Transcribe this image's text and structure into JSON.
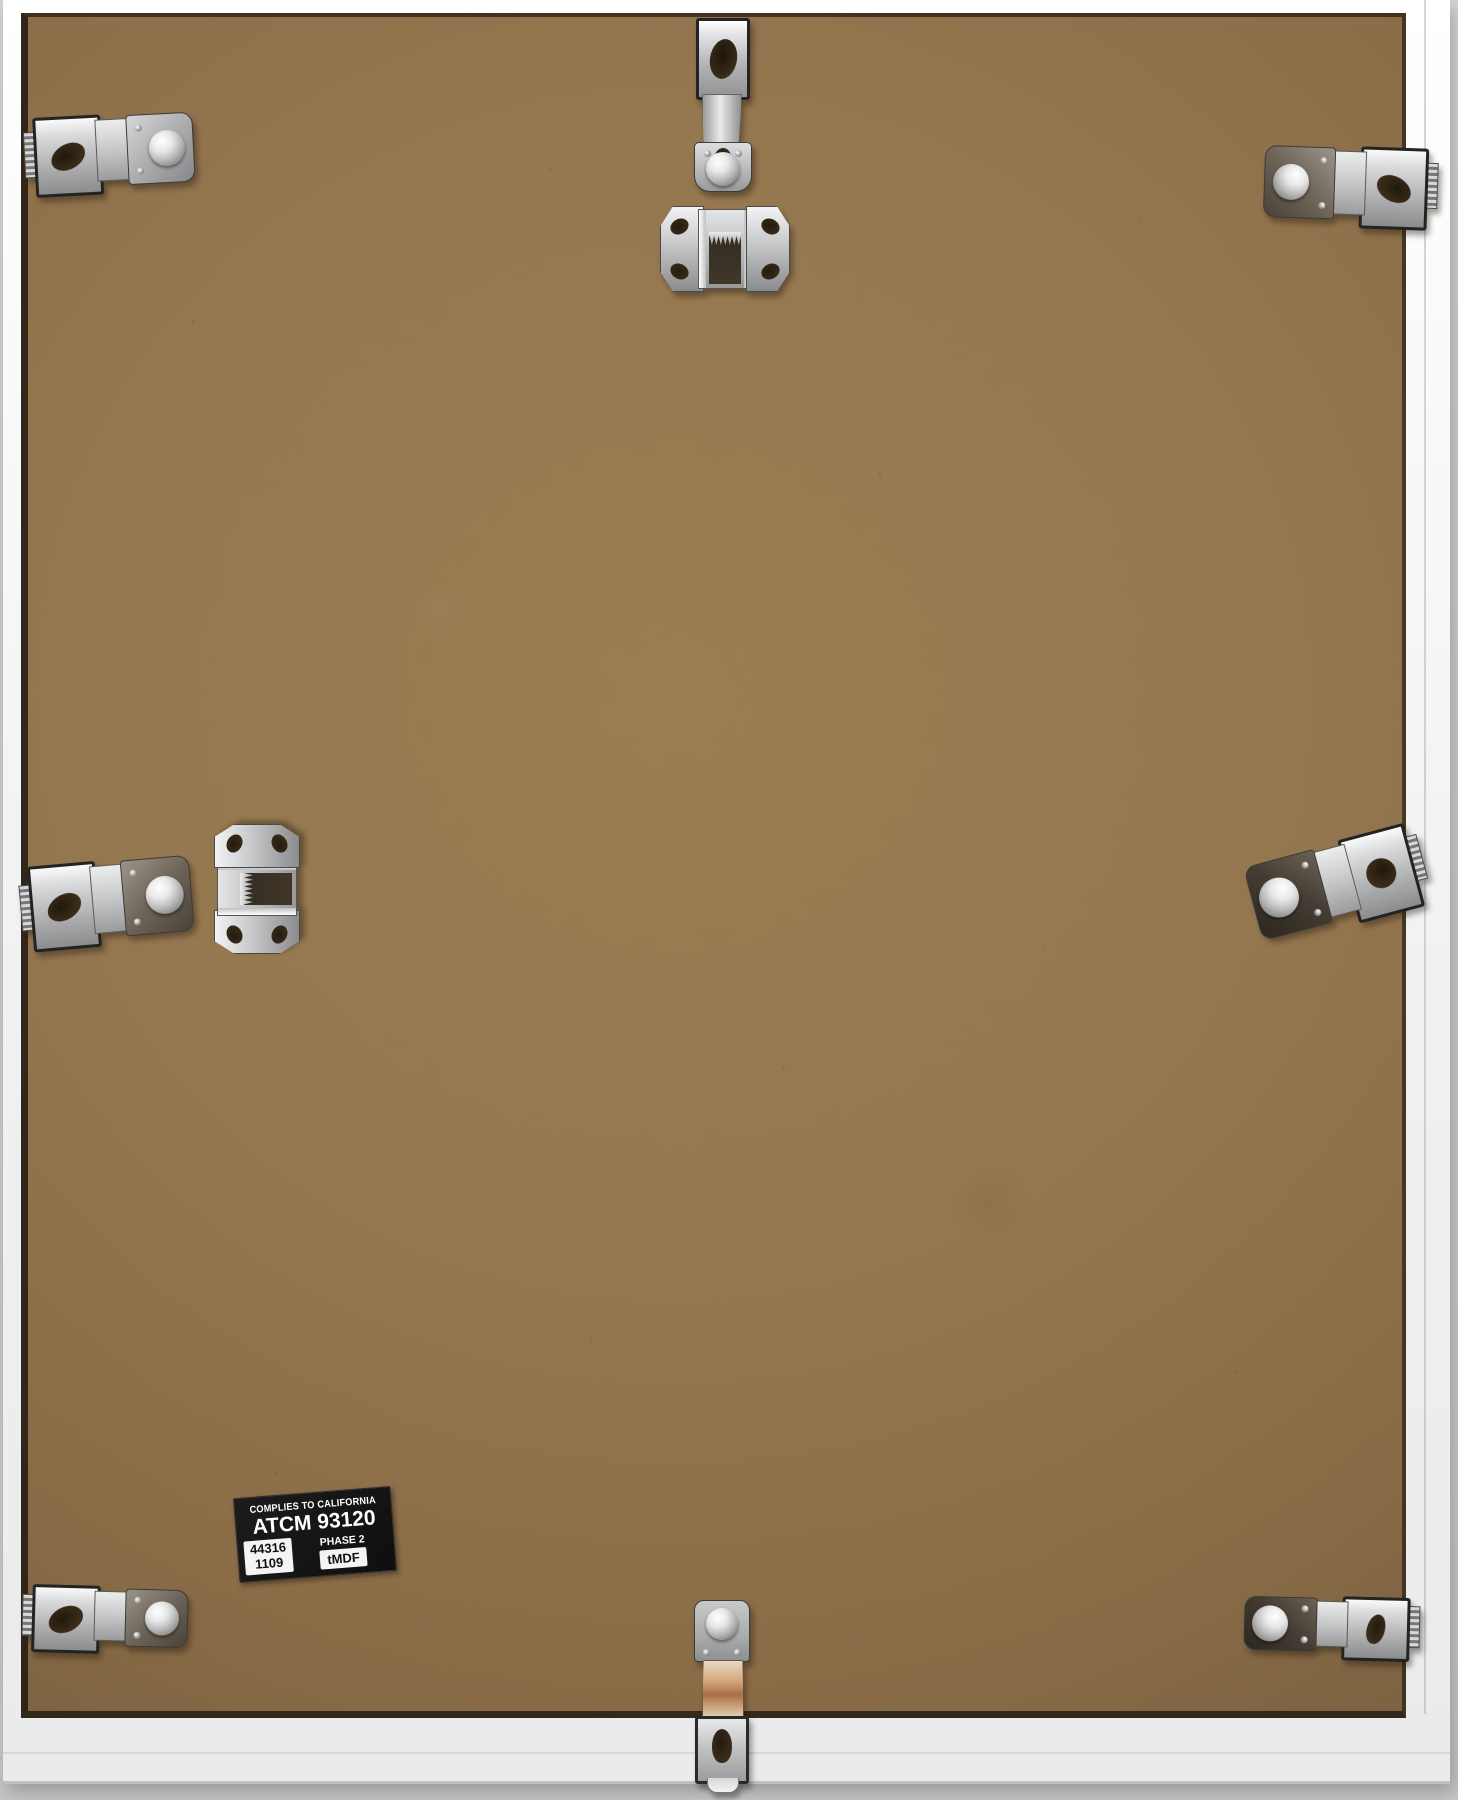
{
  "scene": {
    "alt": "Back of a white aluminum picture frame: brown MDF backing board held by eight chrome spring clips, two sawtooth hangers, and a California compliance sticker"
  },
  "colors": {
    "background_wall": "#cbccce",
    "frame_white": "#f1f2f3",
    "board_brown": "#93754e",
    "board_edge_shadow": "#2a2116",
    "metal_light": "#e9eaeb",
    "metal_dark": "#55565a",
    "copper_reflection": "#a86f46",
    "sticker_bg": "#141414",
    "sticker_text": "#ffffff"
  },
  "sticker": {
    "line1": "COMPLIES TO CALIFORNIA",
    "line2": "ATCM 93120",
    "phase": "PHASE 2",
    "lot_number": "44316",
    "lot_code": "1109",
    "material": "tMDF"
  },
  "hardware": {
    "spring_clips": [
      {
        "position": "top-left"
      },
      {
        "position": "top-center"
      },
      {
        "position": "top-right"
      },
      {
        "position": "middle-left"
      },
      {
        "position": "middle-right"
      },
      {
        "position": "bottom-left"
      },
      {
        "position": "bottom-center"
      },
      {
        "position": "bottom-right"
      }
    ],
    "sawtooth_hangers": [
      {
        "position": "top-center"
      },
      {
        "position": "middle-left"
      }
    ]
  }
}
